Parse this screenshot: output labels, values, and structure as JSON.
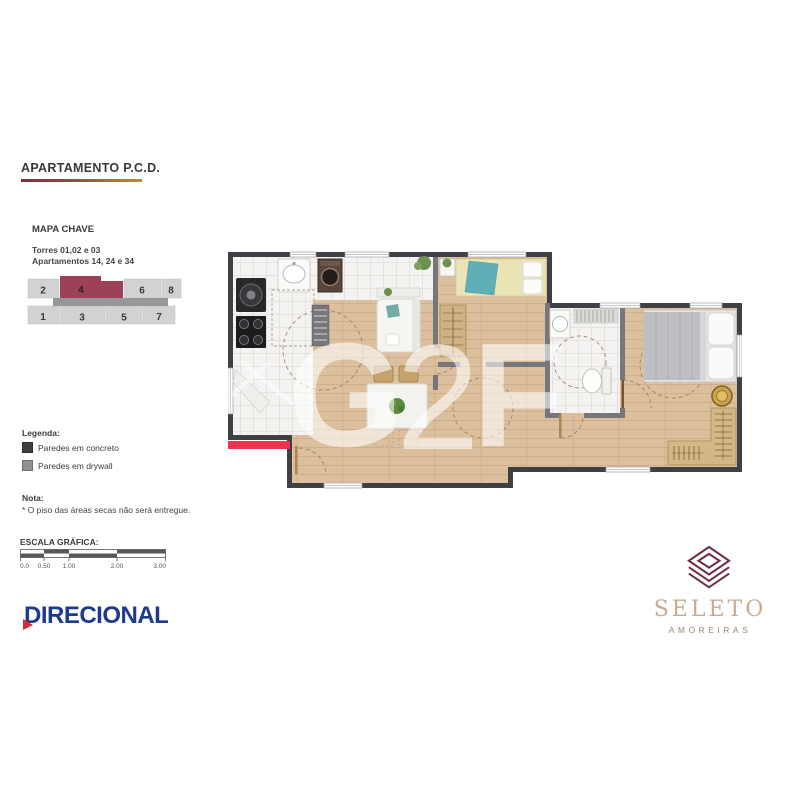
{
  "title": {
    "text": "APARTAMENTO P.C.D."
  },
  "mapa_chave": {
    "heading": "MAPA CHAVE",
    "towers_line": "Torres 01,02 e 03",
    "apartments_line": "Apartamentos 14, 24 e 34",
    "units_top": [
      "2",
      "4",
      "6",
      "8"
    ],
    "units_bottom": [
      "1",
      "3",
      "5",
      "7"
    ],
    "highlighted_unit": "4",
    "highlight_color": "#9b4257"
  },
  "legend": {
    "heading": "Legenda:",
    "items": [
      {
        "label": "Paredes em concreto",
        "swatch_color": "#3f3f41"
      },
      {
        "label": "Paredes em drywall",
        "swatch_color": "#919193"
      }
    ]
  },
  "note": {
    "heading": "Nota:",
    "text": "* O piso das áreas secas não será entregue."
  },
  "scale_bar": {
    "heading": "ESCALA GRÁFICA:",
    "tick_labels": [
      "0.0",
      "0.50",
      "1.00",
      "2.00",
      "3.00"
    ]
  },
  "watermark": {
    "letters": [
      "G",
      "2",
      "F"
    ]
  },
  "branding": {
    "developer_logo_text": "DIRECIONAL",
    "developer_color": "#1d3a8e",
    "developer_accent_color": "#d62b33",
    "project_name": "SELETO",
    "project_subtitle": "AMOREIRAS",
    "project_icon_color": "#6e2f3f",
    "project_name_color": "#c9ac8e"
  },
  "floor_plan": {
    "entry_marker_color": "#ee3350",
    "wall_concrete_color": "#3f4045",
    "wall_drywall_color": "#76767b",
    "wood_floor_color": "#dcc09e",
    "tile_floor_color": "#f4f3f1"
  }
}
